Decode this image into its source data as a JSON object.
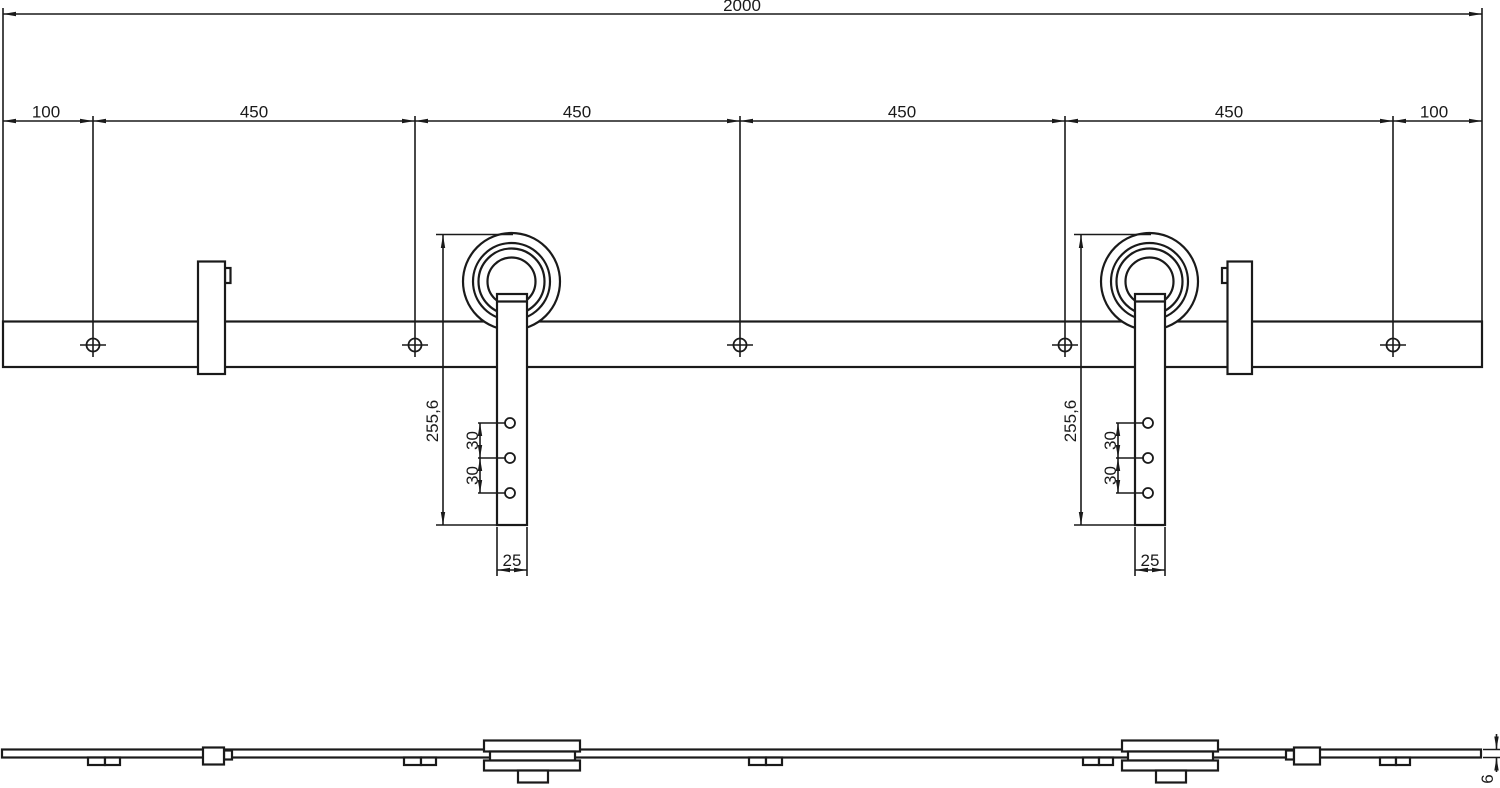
{
  "drawing": {
    "type": "technical-drawing",
    "subject": "sliding-door-rail-with-rollers",
    "dimensions": {
      "overall_length": "2000",
      "segments": [
        "100",
        "450",
        "450",
        "450",
        "450",
        "100"
      ],
      "hanger": {
        "height": "255,6",
        "hole_spacing_upper": "30",
        "hole_spacing_lower": "30",
        "strap_width": "25"
      },
      "rail_thickness": "6"
    },
    "colors": {
      "line": "#1a1a1a",
      "background": "#ffffff"
    }
  }
}
